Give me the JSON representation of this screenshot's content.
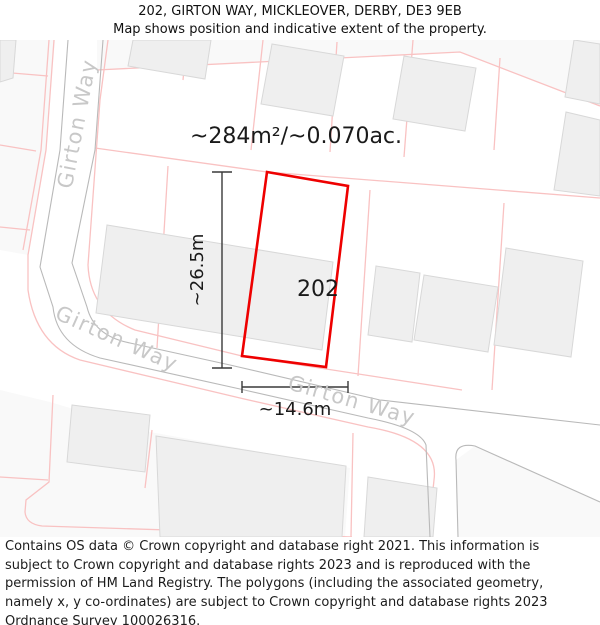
{
  "header": {
    "title": "202, GIRTON WAY, MICKLEOVER, DERBY, DE3 9EB",
    "subtitle": "Map shows position and indicative extent of the property."
  },
  "map": {
    "area_label": "~284m²/~0.070ac.",
    "plot_number": "202",
    "width_label": "~14.6m",
    "height_label": "~26.5m",
    "road_name": "Girton Way",
    "colors": {
      "plot_outline": "#ee0000",
      "parcel_line": "#f9c2c2",
      "road_edge": "#b9b9b9",
      "building_fill": "#efefef",
      "building_edge": "#d8d8d8",
      "road_label": "#c8c8c8",
      "measure": "#3a3a3a"
    }
  },
  "footer": {
    "copyright": "Contains OS data © Crown copyright and database right 2021. This information is subject to Crown copyright and database rights 2023 and is reproduced with the permission of HM Land Registry. The polygons (including the associated geometry, namely x, y co-ordinates) are subject to Crown copyright and database rights 2023 Ordnance Survey 100026316."
  }
}
